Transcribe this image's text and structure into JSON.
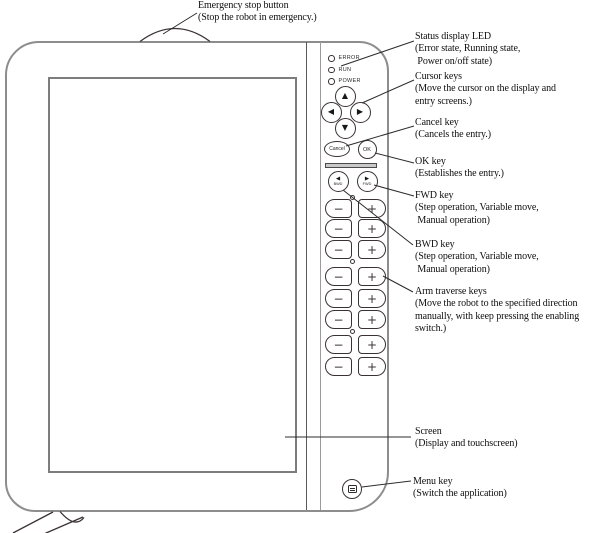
{
  "figure_title": "Teach pendant front view diagram",
  "callouts": [
    {
      "id": "emergency-stop",
      "text": "Emergency stop button\n(Stop the robot in emergency.)"
    },
    {
      "id": "status-led",
      "text": "Status display LED\n(Error state, Running state,\n Power on/off state)"
    },
    {
      "id": "cursor-keys",
      "text": "Cursor keys\n(Move the cursor on the display and\nentry screens.)"
    },
    {
      "id": "cancel-key",
      "text": "Cancel key\n(Cancels the entry.)"
    },
    {
      "id": "ok-key",
      "text": "OK key\n(Establishes the entry.)"
    },
    {
      "id": "fwd-key",
      "text": "FWD key\n(Step operation, Variable move,\n Manual operation)"
    },
    {
      "id": "bwd-key",
      "text": "BWD key\n(Step operation, Variable move,\n Manual operation)"
    },
    {
      "id": "arm-traverse",
      "text": "Arm traverse keys\n(Move the robot to the specified direction\nmanually, with keep pressing the enabling\nswitch.)"
    },
    {
      "id": "screen",
      "text": "Screen\n(Display and touchscreen)"
    },
    {
      "id": "menu-key",
      "text": "Menu key\n(Switch the application)"
    }
  ],
  "panel": {
    "leds": [
      {
        "label": "ERROR"
      },
      {
        "label": "RUN"
      },
      {
        "label": "POWER"
      }
    ],
    "cursor": {
      "up": "▲",
      "left": "◀",
      "right": "▶",
      "down": "▼"
    },
    "cancel_label": "Cancel",
    "ok_label": "OK",
    "bwd": {
      "arrow": "◀",
      "label": "BWD"
    },
    "fwd": {
      "arrow": "▶",
      "label": "FWD"
    },
    "minus_label": "−",
    "plus_label": "+"
  },
  "colors": {
    "line_dark": "#3a3136",
    "line_gray": "#8d8d8d",
    "text": "#0e0e0e",
    "bar_fill": "#c9c9c9"
  }
}
